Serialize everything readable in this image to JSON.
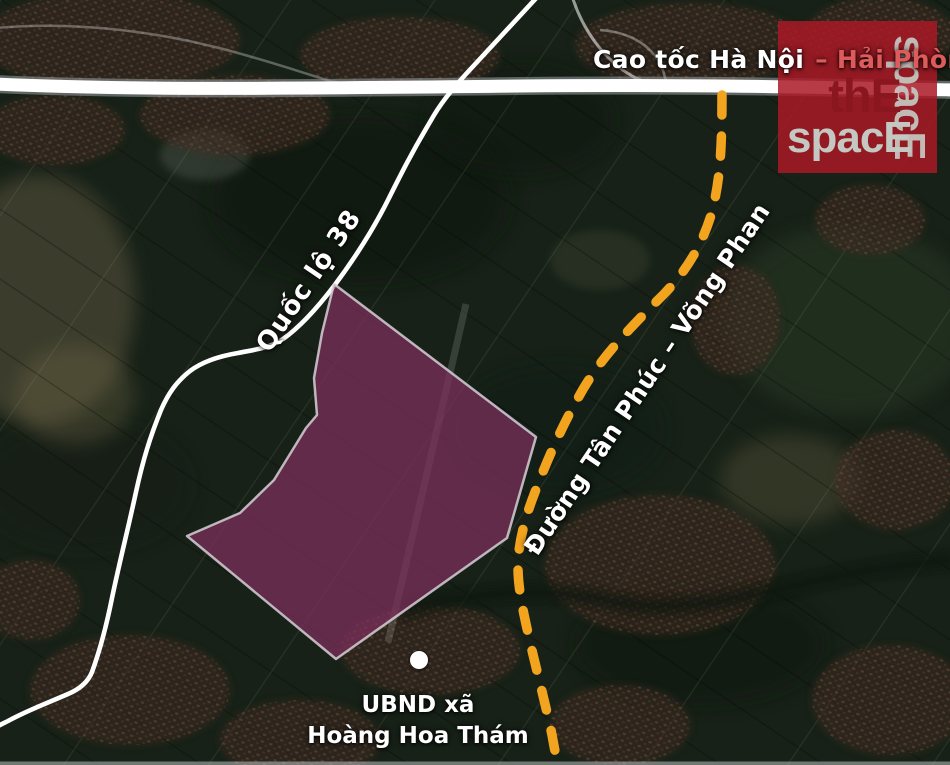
{
  "map": {
    "labels": {
      "expressway_main": "Cao tốc Hà Nội",
      "expressway_highlight": " – Hải Phòng",
      "route38": "Quốc lộ 38",
      "tan_phuc_road": "Đường Tân Phúc – Võng Phan",
      "poi_line1": "UBND xã",
      "poi_line2": "Hoàng Hoa Thám"
    },
    "poi": {
      "marker": "white-dot"
    },
    "colors": {
      "dashed_road": "#F2A41F",
      "planned_area_fill": "#7E2F5D",
      "planned_area_border": "#D6D0D6",
      "road_white": "#FFFFFF",
      "expressway_label_highlight": "#DE5B5B",
      "marker": "#FFFFFF",
      "watermark_bg": "rgba(169,25,38,0.85)",
      "watermark_dark_text": "#8A1620",
      "watermark_light_text": "#C5C8C2"
    },
    "watermark": {
      "line1": "thE",
      "line2": "spacE",
      "vertical": "spacE"
    }
  }
}
